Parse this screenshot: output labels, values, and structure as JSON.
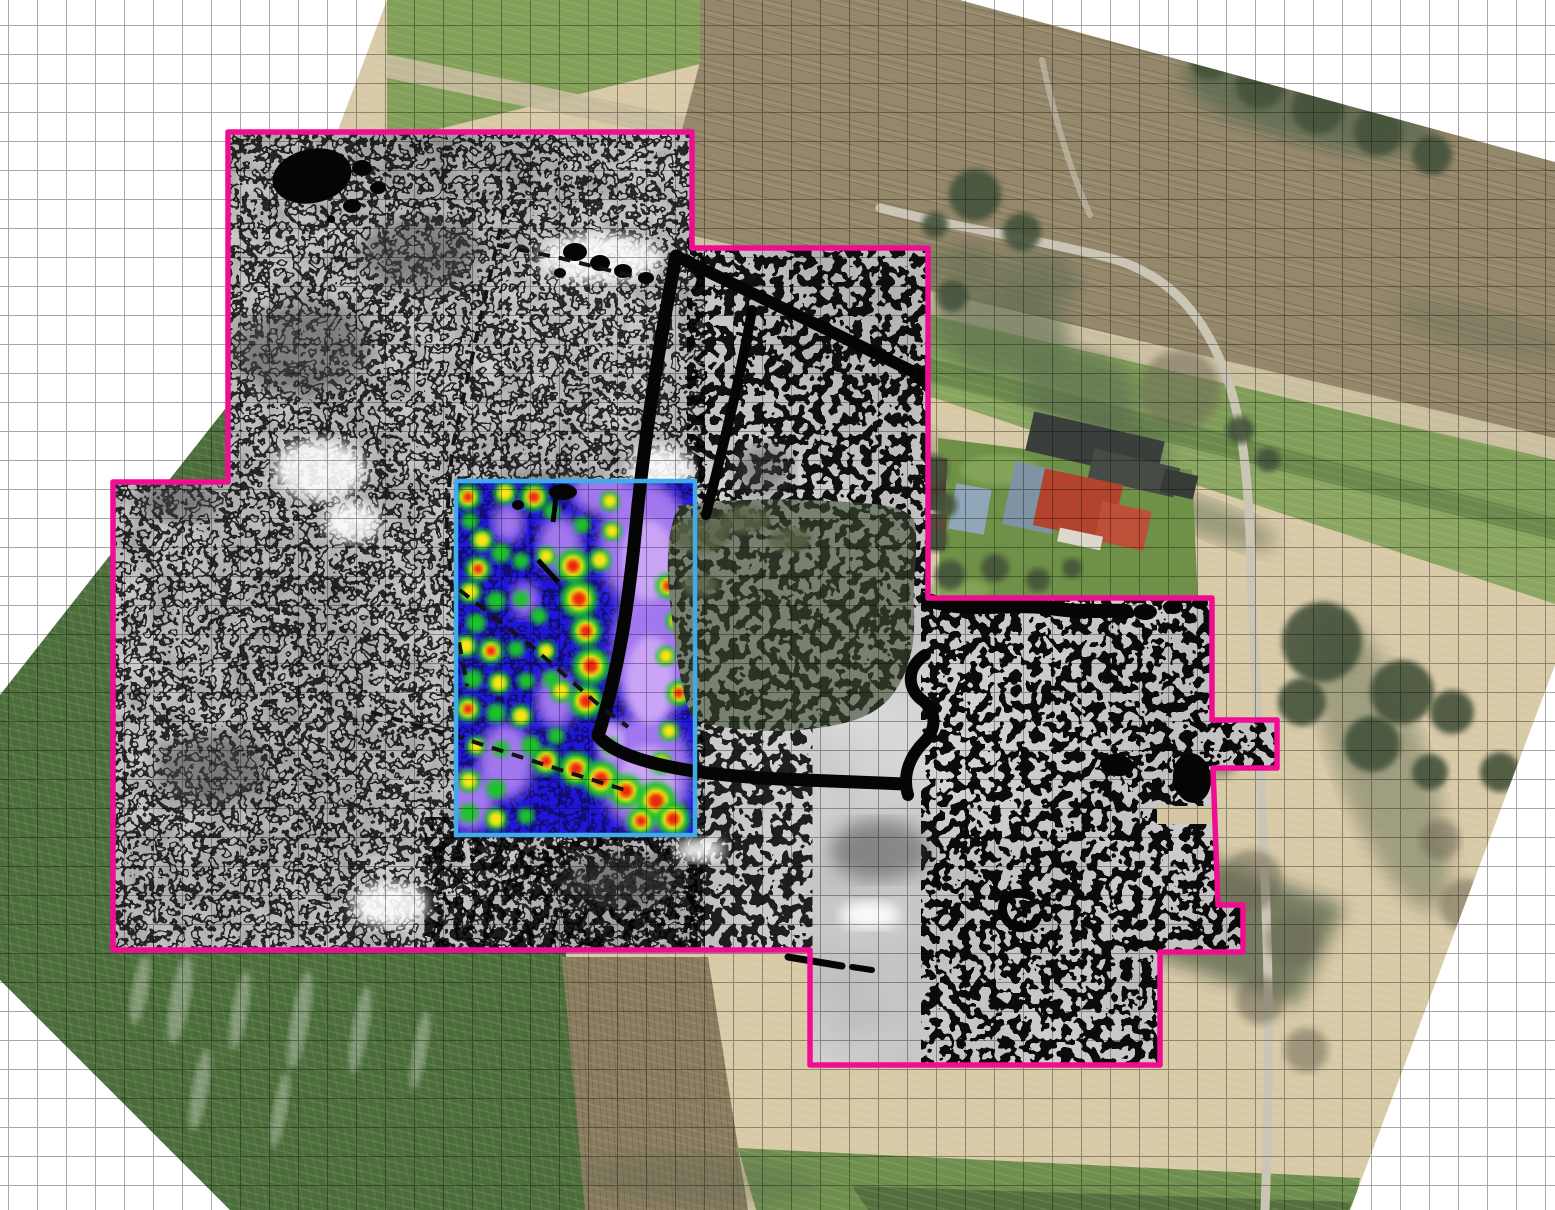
{
  "app": {
    "type": "gis-map-composite",
    "description": "Aerial orthophoto basemap with archaeological geophysics overlays: magnetometry greyscale plot outlined in magenta and a GPR colour amplitude plot outlined in cyan, on a white gridded canvas"
  },
  "canvas": {
    "width": 1555,
    "height": 1210,
    "background": "#ffffff"
  },
  "grid": {
    "spacing_px": 29,
    "offset_x": 8,
    "offset_y": -4,
    "color": "#999999"
  },
  "colors": {
    "magenta_outline": "#f10d92",
    "cyan_border": "#41abe9",
    "gpr_blue": "#2016d8",
    "purple": "#a97df2",
    "purple_light": "#cfa9f7",
    "hot_green": "#1fc32a",
    "hot_yellow": "#ffe414",
    "hot_red": "#e92507",
    "survey_gray": "#dedede",
    "field_dark_green": "#4b6d3a",
    "stubble_tan": "#d8c9a7",
    "plow_brown": "#94876a",
    "roof_red": "#b2442e"
  },
  "orthophoto": {
    "label": "orthophoto-basemap",
    "outline": "387,0 960,0 1555,162 1555,665 1350,1210 230,1210 0,980 0,695 240,390",
    "fields": {
      "green_tl": "387,0 726,0 700,64 387,142",
      "pale_tl": "387,54 700,120 700,142 387,78",
      "brown_top": "700,0 960,0 1555,162 1555,446 655,232 700,62",
      "pale_strip": "652,226 1555,438 1555,464 650,254",
      "green_band1": "650,250 1555,460 1555,522 700,302 650,284",
      "dark_strip": "700,300 1555,518 1555,544 706,328",
      "green_band2": "706,326 1555,540 1555,604 934,398 706,364",
      "left_field": "150,250 240,250 240,486 115,486 113,944 565,944 590,1210 225,1210 0,982 0,560",
      "brown_bottom": "562,957 708,957 748,1210 585,1210",
      "green_bottom": "738,1148 1360,1178 1354,1210 756,1210",
      "green_bottom_dark": "852,1186 1352,1202 1348,1210 868,1210",
      "lawn": "938,438 1192,470 1198,602 940,610",
      "shadow_blob": "1150,836 1345,906 1296,1006 1142,952"
    },
    "roads": {
      "main": "M880,208 C960,228 1040,240 1110,258 C1170,275 1205,315 1228,380 C1248,440 1250,520 1252,600 C1258,720 1264,840 1267,940 C1270,1040 1268,1130 1265,1210",
      "spur": "M1042,60 C1055,120 1070,170 1090,215",
      "drive": "M1190,490 C1168,500 1148,506 1126,509"
    },
    "trees_dark": [
      [
        975,
        195,
        26
      ],
      [
        1022,
        232,
        19
      ],
      [
        952,
        296,
        16
      ],
      [
        935,
        225,
        13
      ],
      [
        932,
        470,
        16
      ],
      [
        944,
        505,
        13
      ],
      [
        936,
        540,
        12
      ],
      [
        950,
        575,
        15
      ],
      [
        995,
        568,
        14
      ],
      [
        1038,
        580,
        12
      ],
      [
        1072,
        568,
        10
      ],
      [
        1322,
        642,
        40
      ],
      [
        1402,
        692,
        32
      ],
      [
        1372,
        744,
        28
      ],
      [
        1302,
        702,
        24
      ],
      [
        1452,
        712,
        22
      ],
      [
        1500,
        772,
        20
      ],
      [
        1430,
        772,
        18
      ],
      [
        1210,
        60,
        20
      ],
      [
        1260,
        85,
        24
      ],
      [
        1318,
        108,
        26
      ],
      [
        1378,
        132,
        24
      ],
      [
        1432,
        155,
        20
      ],
      [
        1240,
        430,
        14
      ],
      [
        1268,
        460,
        12
      ]
    ],
    "trees_bare": [
      [
        1252,
        880,
        30
      ],
      [
        1292,
        940,
        26
      ],
      [
        1260,
        1000,
        24
      ],
      [
        1306,
        1050,
        22
      ],
      [
        1466,
        905,
        26
      ],
      [
        1505,
        960,
        24
      ],
      [
        1440,
        840,
        20
      ],
      [
        1180,
        390,
        40
      ],
      [
        1220,
        760,
        18
      ]
    ],
    "shadows": [
      [
        1000,
        330,
        70,
        45,
        10,
        0.6
      ],
      [
        1080,
        390,
        60,
        40,
        15,
        0.6
      ],
      [
        1040,
        280,
        40,
        28,
        10,
        0.55
      ],
      [
        970,
        265,
        35,
        22,
        10,
        0.55
      ],
      [
        1120,
        450,
        50,
        35,
        15,
        0.55
      ],
      [
        900,
        270,
        35,
        25,
        5,
        0.6
      ],
      [
        1310,
        105,
        130,
        38,
        14,
        0.8
      ],
      [
        1210,
        520,
        70,
        18,
        20,
        0.5
      ],
      [
        860,
        430,
        90,
        20,
        14,
        0.4
      ],
      [
        1380,
        760,
        160,
        45,
        70,
        0.45
      ],
      [
        1480,
        330,
        90,
        22,
        14,
        0.3
      ],
      [
        700,
        1180,
        120,
        25,
        3,
        0.35
      ]
    ],
    "streaks": [
      [
        180,
        1000,
        10,
        45
      ],
      [
        240,
        1010,
        8,
        40
      ],
      [
        300,
        1020,
        9,
        50
      ],
      [
        140,
        990,
        8,
        35
      ],
      [
        360,
        1030,
        8,
        45
      ],
      [
        420,
        1050,
        7,
        40
      ],
      [
        200,
        1090,
        8,
        42
      ],
      [
        280,
        1110,
        7,
        38
      ]
    ],
    "lawn_patches": [
      [
        1000,
        470,
        40,
        15
      ],
      [
        1080,
        490,
        35,
        12
      ],
      [
        960,
        590,
        30,
        10
      ]
    ],
    "farm_shapes": [
      [
        1028,
        426,
        134,
        40,
        13,
        "#3b3f3b"
      ],
      [
        1090,
        458,
        88,
        30,
        13,
        "#474b46"
      ],
      [
        1162,
        472,
        34,
        24,
        13,
        "#383c38"
      ],
      [
        1008,
        466,
        52,
        64,
        12,
        "#7e93a3"
      ],
      [
        1038,
        476,
        80,
        58,
        12,
        "#b2442e"
      ],
      [
        1098,
        506,
        50,
        40,
        12,
        "#bf5038"
      ],
      [
        1058,
        532,
        44,
        14,
        12,
        "#ddd8cb"
      ],
      [
        952,
        486,
        36,
        46,
        10,
        "#8fa7b8"
      ],
      [
        924,
        458,
        22,
        52,
        3,
        "#4c4136"
      ],
      [
        924,
        514,
        22,
        36,
        3,
        "#5a4c3e"
      ],
      [
        908,
        528,
        10,
        7,
        0,
        "#e9e9e3"
      ],
      [
        918,
        542,
        8,
        6,
        0,
        "#e9e9e3"
      ]
    ]
  },
  "magnetometry": {
    "label": "magnetometry-survey",
    "outline_color": "#f10d92",
    "outline": "228,132 692,132 692,248 928,248 928,598 1212,598 1212,720 1277,720 1277,768 1213,768 1218,905 1243,905 1243,952 1160,952 1160,1065 810,1065 810,950 113,950 113,482 228,482",
    "black_blobs": [
      [
        312,
        176,
        40,
        27,
        -12
      ],
      [
        362,
        168,
        10,
        8,
        0
      ],
      [
        352,
        206,
        9,
        7,
        0
      ],
      [
        378,
        188,
        8,
        6,
        0
      ],
      [
        331,
        219,
        4,
        4,
        0
      ],
      [
        925,
        378,
        11,
        9,
        0
      ],
      [
        1117,
        765,
        17,
        11,
        8
      ],
      [
        1192,
        778,
        19,
        25,
        -8
      ],
      [
        1145,
        612,
        12,
        8,
        0
      ],
      [
        1173,
        607,
        10,
        7,
        0
      ],
      [
        1200,
        603,
        8,
        6,
        0
      ],
      [
        575,
        252,
        12,
        9,
        0
      ],
      [
        600,
        263,
        10,
        8,
        0
      ],
      [
        623,
        271,
        9,
        7,
        0
      ],
      [
        646,
        278,
        8,
        6,
        0
      ],
      [
        560,
        273,
        6,
        5,
        0
      ],
      [
        808,
        962,
        6,
        4,
        0
      ]
    ],
    "white_patches": [
      [
        600,
        258,
        62,
        24
      ],
      [
        320,
        470,
        46,
        30
      ],
      [
        352,
        522,
        28,
        20
      ],
      [
        660,
        470,
        32,
        24
      ],
      [
        390,
        905,
        38,
        22
      ],
      [
        870,
        915,
        30,
        14
      ],
      [
        700,
        850,
        25,
        12
      ]
    ],
    "dark_patches": [
      [
        180,
        500,
        42,
        20
      ],
      [
        548,
        498,
        62,
        24
      ],
      [
        762,
        470,
        30,
        26
      ],
      [
        210,
        770,
        55,
        35
      ],
      [
        420,
        255,
        60,
        35
      ],
      [
        300,
        350,
        70,
        45
      ],
      [
        620,
        880,
        60,
        25
      ],
      [
        880,
        850,
        50,
        30
      ]
    ],
    "fences": {
      "l1": "M676,256 C660,340 646,430 638,505 C630,590 622,660 598,736 C622,764 700,775 780,779 L905,784",
      "l2": "M678,257 L920,375",
      "l3": "M752,310 C740,380 722,450 706,515",
      "l4": "M928,600 C970,614 1010,602 1050,608 C1080,613 1104,610 1126,611",
      "l5": "M925,655 C905,668 908,690 922,700 C938,712 936,730 924,742 C910,756 902,775 908,795",
      "c_mark": "M1031,896 C1008,886 994,906 1008,922 C1018,932 1034,928 1037,918",
      "dash_a": "M788,957 L842,966",
      "dash_b": "M852,967 L872,970"
    },
    "dashed_boundaries": [
      "505,208 478,330 452,450 446,530 456,625 467,686",
      "371,712 468,740 567,772 625,790",
      "443,577 530,645 600,706 628,727",
      "497,245 560,258 640,278"
    ],
    "tan_gap": "1157,806 1217,806 1217,824 1157,824"
  },
  "gpr": {
    "label": "gpr-amplitude-overlay",
    "border_color": "#41abe9",
    "rect": {
      "x": 458,
      "y": 483,
      "width": 235,
      "height": 350
    },
    "purple_patches": [
      [
        645,
        545,
        46,
        64
      ],
      [
        652,
        650,
        40,
        74
      ],
      [
        645,
        772,
        46,
        58
      ],
      [
        601,
        491,
        30,
        24
      ],
      [
        560,
        545,
        22,
        30
      ],
      [
        506,
        761,
        28,
        38
      ],
      [
        470,
        801,
        25,
        30
      ],
      [
        556,
        700,
        20,
        28
      ],
      [
        508,
        523,
        16,
        20
      ],
      [
        525,
        600,
        14,
        18
      ]
    ],
    "purple_light": [
      [
        648,
        560,
        26,
        40
      ],
      [
        650,
        680,
        24,
        44
      ],
      [
        648,
        780,
        28,
        34
      ],
      [
        610,
        740,
        14,
        20
      ]
    ],
    "hotspots": [
      [
        468,
        497,
        9,
        3
      ],
      [
        505,
        493,
        8,
        2
      ],
      [
        534,
        497,
        10,
        3
      ],
      [
        470,
        521,
        6,
        1
      ],
      [
        552,
        511,
        6,
        1
      ],
      [
        610,
        501,
        7,
        2
      ],
      [
        482,
        540,
        8,
        2
      ],
      [
        501,
        553,
        7,
        1
      ],
      [
        478,
        569,
        9,
        3
      ],
      [
        521,
        561,
        6,
        1
      ],
      [
        546,
        556,
        7,
        2
      ],
      [
        600,
        560,
        8,
        2
      ],
      [
        470,
        592,
        8,
        2
      ],
      [
        496,
        601,
        7,
        1
      ],
      [
        521,
        599,
        6,
        1
      ],
      [
        476,
        623,
        7,
        1
      ],
      [
        539,
        616,
        6,
        1
      ],
      [
        466,
        646,
        8,
        2
      ],
      [
        491,
        651,
        9,
        3
      ],
      [
        516,
        649,
        6,
        1
      ],
      [
        546,
        651,
        7,
        2
      ],
      [
        473,
        679,
        7,
        1
      ],
      [
        499,
        683,
        8,
        2
      ],
      [
        526,
        681,
        6,
        1
      ],
      [
        551,
        679,
        6,
        1
      ],
      [
        468,
        709,
        9,
        3
      ],
      [
        496,
        713,
        7,
        1
      ],
      [
        521,
        716,
        8,
        2
      ],
      [
        556,
        736,
        6,
        1
      ],
      [
        476,
        746,
        7,
        2
      ],
      [
        501,
        749,
        6,
        1
      ],
      [
        531,
        746,
        7,
        1
      ],
      [
        610,
        746,
        6,
        1
      ],
      [
        469,
        781,
        8,
        2
      ],
      [
        496,
        789,
        7,
        1
      ],
      [
        469,
        813,
        7,
        1
      ],
      [
        496,
        819,
        8,
        2
      ],
      [
        526,
        816,
        6,
        1
      ],
      [
        573,
        566,
        12,
        3
      ],
      [
        579,
        599,
        13,
        3
      ],
      [
        586,
        631,
        11,
        3
      ],
      [
        591,
        666,
        13,
        3
      ],
      [
        586,
        701,
        12,
        3
      ],
      [
        561,
        691,
        8,
        2
      ],
      [
        546,
        761,
        10,
        3
      ],
      [
        576,
        769,
        12,
        3
      ],
      [
        601,
        779,
        13,
        3
      ],
      [
        626,
        791,
        12,
        3
      ],
      [
        656,
        801,
        14,
        3
      ],
      [
        673,
        819,
        12,
        3
      ],
      [
        641,
        821,
        10,
        3
      ],
      [
        668,
        586,
        9,
        3
      ],
      [
        677,
        621,
        8,
        3
      ],
      [
        666,
        656,
        7,
        2
      ],
      [
        679,
        693,
        9,
        3
      ],
      [
        669,
        731,
        7,
        2
      ],
      [
        661,
        763,
        8,
        3
      ],
      [
        612,
        531,
        7,
        2
      ],
      [
        582,
        525,
        6,
        1
      ]
    ],
    "marks": [
      "M556,498 L553,522",
      "M538,560 L558,582"
    ],
    "mark_blobs": [
      [
        563,
        492,
        14,
        8
      ],
      [
        518,
        505,
        6,
        5
      ]
    ]
  },
  "forest": {
    "path": "M678,506 C730,498 790,498 845,502 C880,504 905,506 914,520 C920,545 912,575 914,612 C916,650 906,680 888,700 C868,720 840,726 800,730 C758,733 710,728 692,718 C680,690 676,650 671,610 C666,568 666,535 678,506 Z",
    "highlights": [
      [
        700,
        535,
        30,
        18
      ],
      [
        745,
        520,
        26,
        14
      ],
      [
        790,
        540,
        22,
        12
      ],
      [
        700,
        585,
        18,
        12
      ]
    ]
  }
}
